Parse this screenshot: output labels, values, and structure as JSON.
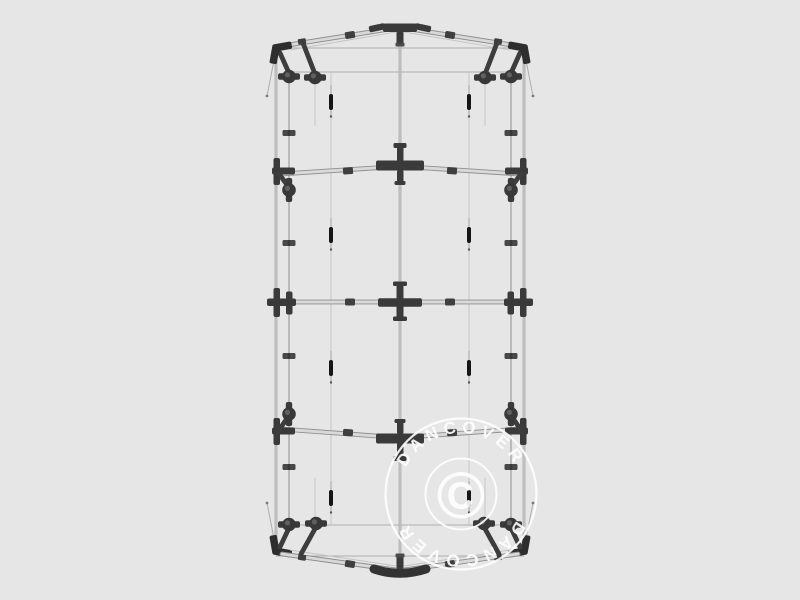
{
  "page": {
    "background_color": "#e6e6e6",
    "subject": "tent-frame-top-view-illustration"
  },
  "watermark": {
    "ring_text_top": "DANCOVER",
    "ring_text_bottom": "DANCOVER",
    "center_symbol": "©",
    "color": "#ffffff"
  },
  "colors": {
    "background": "#e6e6e6",
    "frame_tube_light": "#d9d9d9",
    "frame_tube_edge": "#8f8f8f",
    "thin_line": "#aeaeae",
    "connector": "#3a3a3a",
    "strap_marker": "#161616",
    "watermark": "#ffffff"
  }
}
